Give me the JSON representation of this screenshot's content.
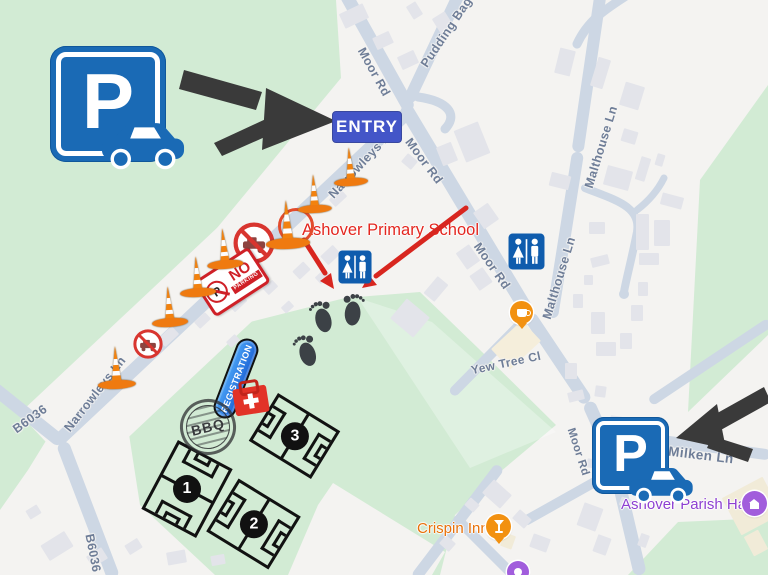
{
  "map": {
    "road_labels": {
      "pudding_bag_ln": "Pudding Bag Ln",
      "moor_rd": "Moor Rd",
      "narrowleys_ln": "Narrowleys Ln",
      "b6036": "B6036",
      "malthouse_ln": "Malthouse Ln",
      "yew_tree_cl": "Yew Tree Cl",
      "milken_ln": "Milken Ln"
    },
    "poi_labels": {
      "school": "Ashover Primary School",
      "crispin_inn": "Crispin Inn",
      "parish_hall": "Ashover Parish Hall"
    }
  },
  "annotations": {
    "entry_badge": "ENTRY",
    "registration_banner": "REGISTRATION",
    "bbq_stamp": "BBQ",
    "parking_sign_letter": "P",
    "no_parking_sign": {
      "p": "P",
      "no": "NO",
      "parking": "PARKING"
    },
    "pitches": [
      {
        "number": "1"
      },
      {
        "number": "2"
      },
      {
        "number": "3"
      }
    ]
  },
  "colors": {
    "map_green": "#d2ebd4",
    "map_background": "#f4f3f1",
    "road_fill": "#cdd7e4",
    "building_fill": "#e3e4ea",
    "parking_blue": "#1a6ab5",
    "entry_badge_blue": "#4355c8",
    "registration_blue": "#2b7de1",
    "toilet_blue": "#0f5cad",
    "cone_orange": "#f2820f",
    "alert_red": "#d8352f",
    "school_label_red": "#e3261f",
    "crispin_orange": "#e8710a",
    "parish_purple": "#8d3fd1",
    "footprint_gray": "#3c4146",
    "arrow_black": "#3a3a3a"
  }
}
